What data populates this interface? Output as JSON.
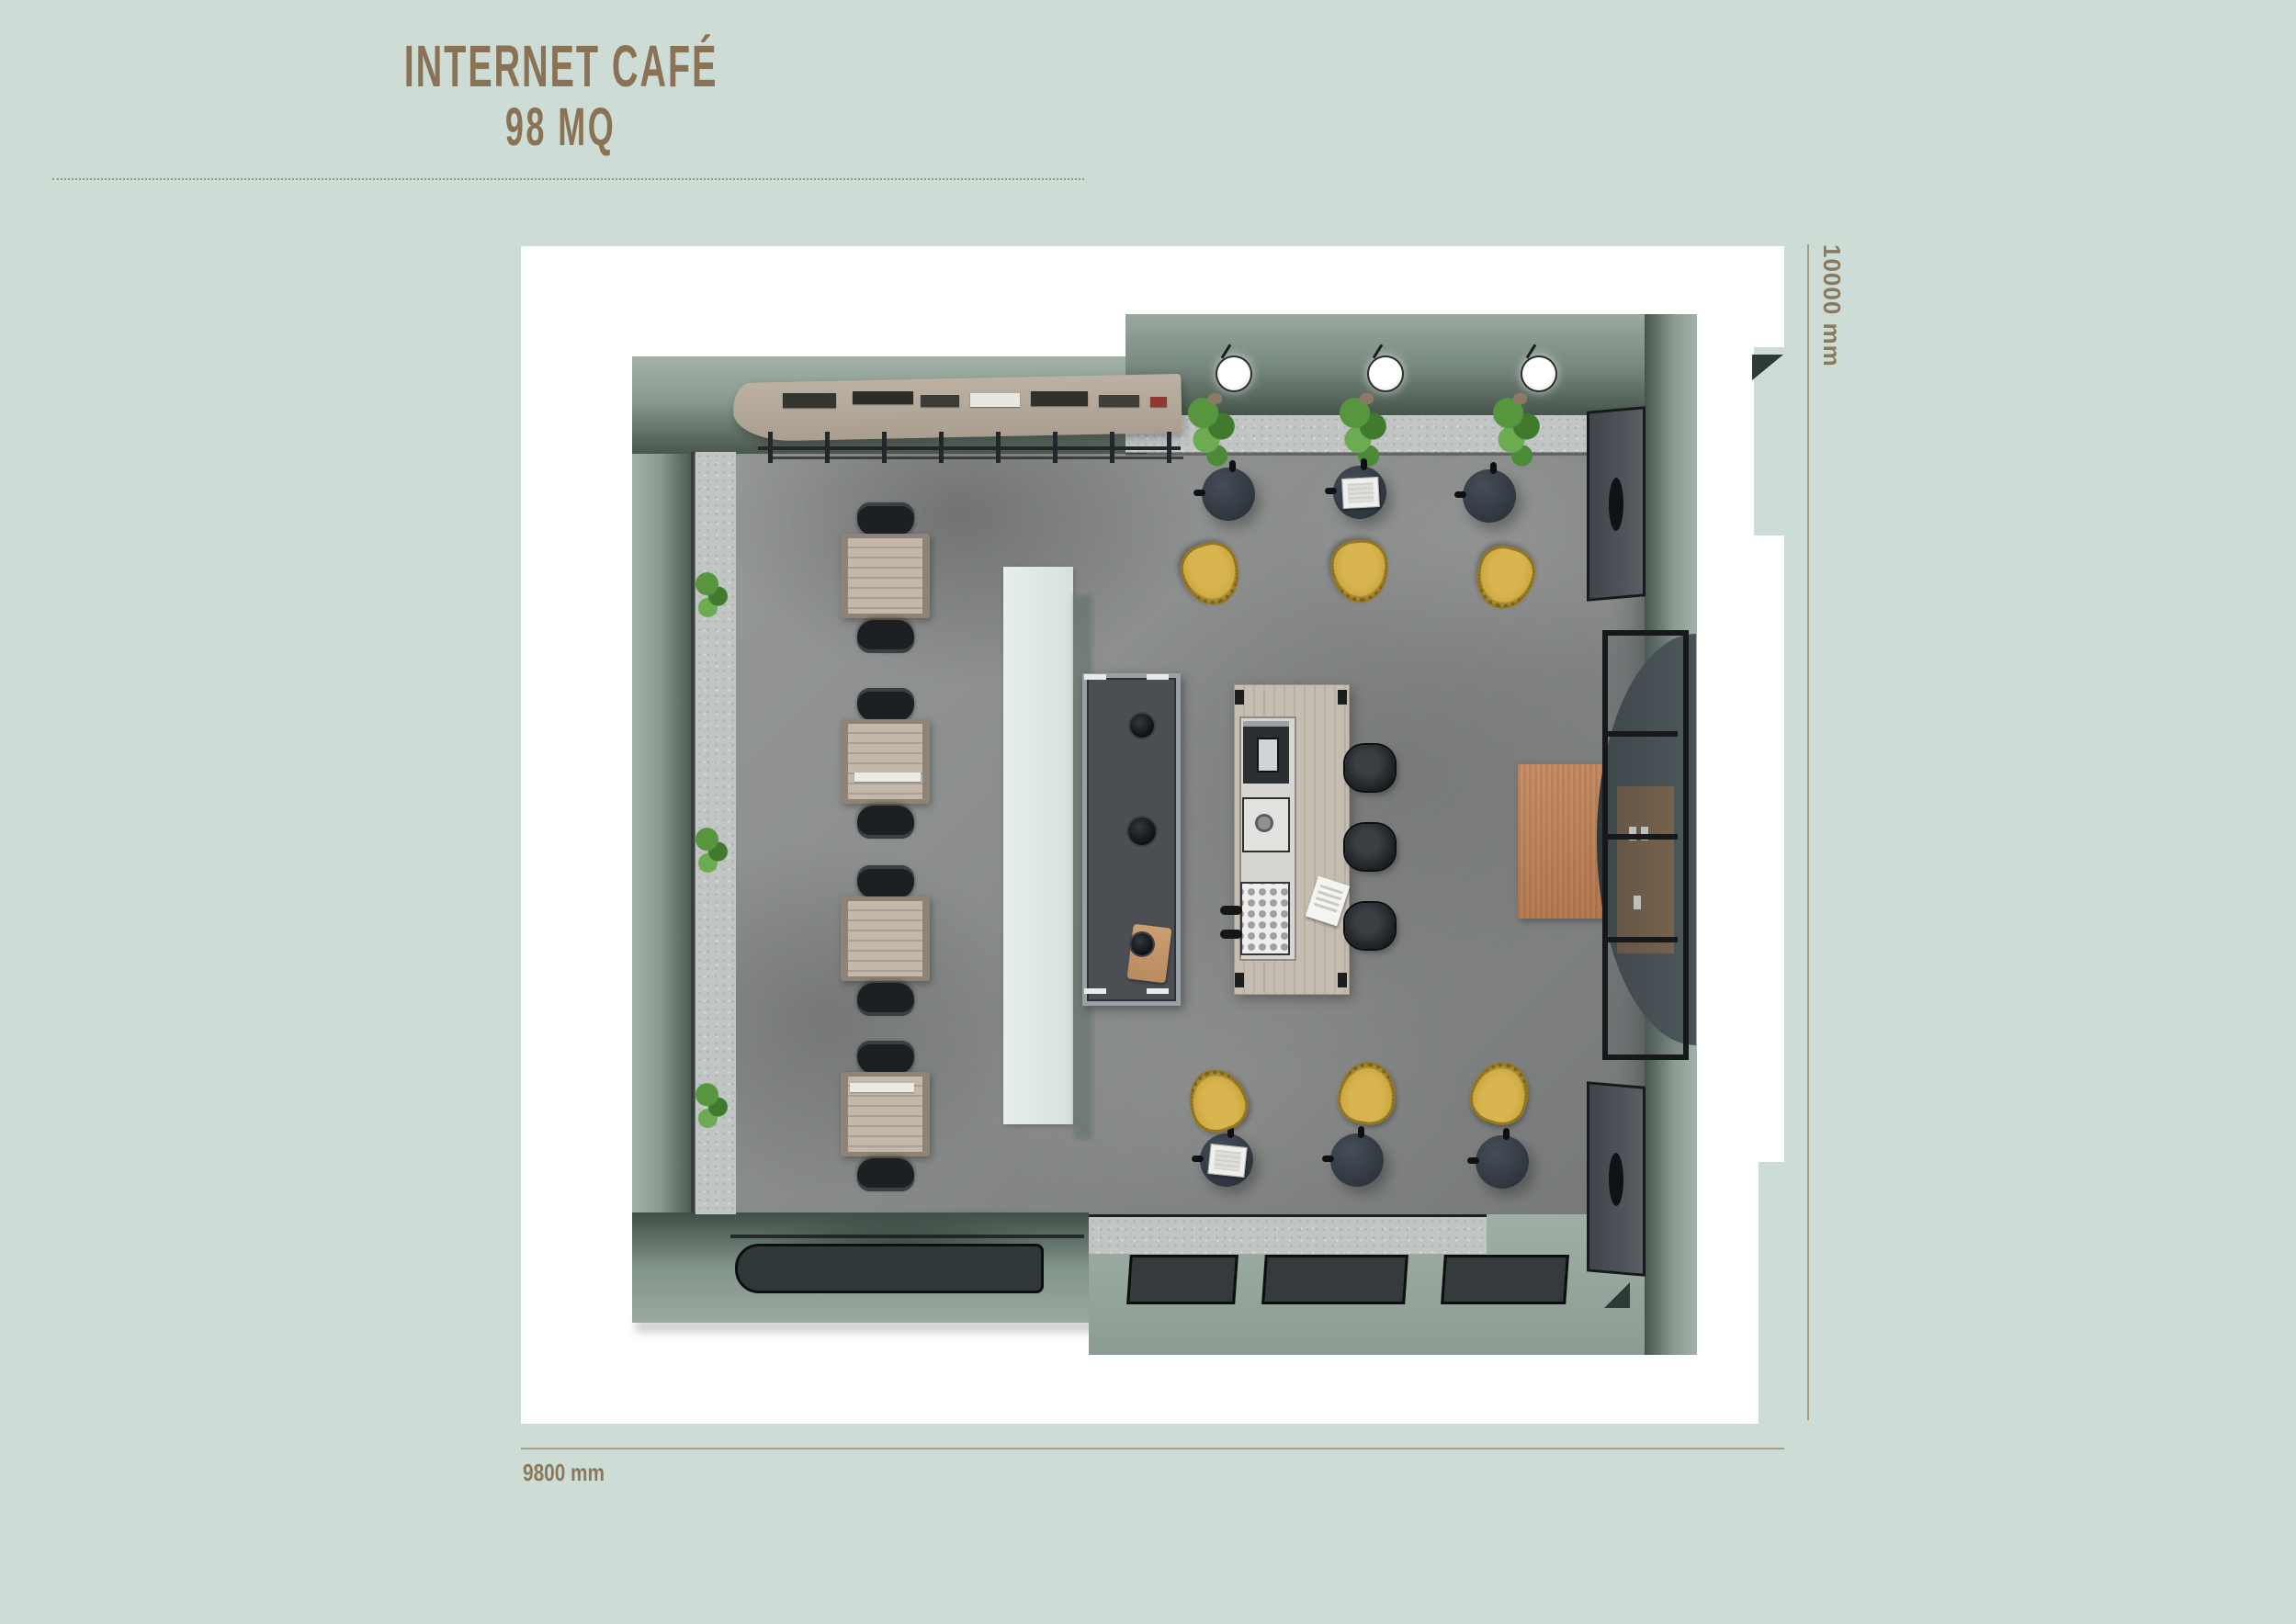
{
  "title": {
    "line1": "INTERNET CAFÉ",
    "line2": "98 MQ"
  },
  "dimensions": {
    "vertical_label": "10000 mm",
    "horizontal_label": "9800 mm"
  },
  "colors": {
    "page_bg": "#cddcd4",
    "title_text": "#8a7256",
    "dim_text": "#8a795c",
    "dim_line": "#a4906c",
    "paper": "#ffffff",
    "wall_outer": "#9caba2",
    "wall_inner": "#47564d",
    "floor_base": "#8b8e8d",
    "walkway": "#95a49b",
    "speckle": "#c1c5c4",
    "mint": "#d6e0dc",
    "wood_island": "#c2b9ae",
    "wood_desk": "#bdb2a4",
    "wood_reception": "#b3a89a",
    "counter_dark": "#4b4e52",
    "table_dark": "#2e353d",
    "chair_black": "#1d2023",
    "chair_yellow": "#c7a33c",
    "stool_black": "#17191c",
    "rug": "#b5794f",
    "plant": "#57963f",
    "mat": "#31383a",
    "glass_frame": "#16181a",
    "cabinet_wood": "#84613f"
  },
  "furniture_inventory": {
    "internet_desks": 4,
    "desk_chairs": 8,
    "round_cafe_tables": 6,
    "yellow_shell_chairs": 6,
    "bar_stools": 3,
    "pendant_lamps": 3,
    "hanging_plants": 3,
    "bench_plants": 3,
    "laptops": 2,
    "entry_floor_mats": 3,
    "entrance_mat": 1,
    "rug": 1,
    "service_counter": 1,
    "bar_island": 1,
    "reception_shelf": 1,
    "acoustic_wall_panels": 2,
    "glass_display_cabinet": 1
  }
}
